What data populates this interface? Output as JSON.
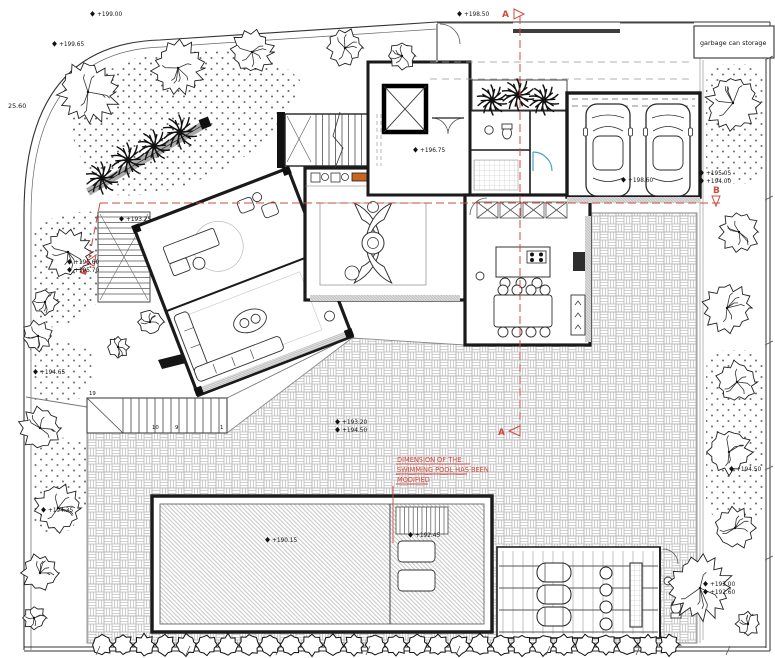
{
  "title": "villa-ground-floor-site-plan",
  "labels": {
    "garbage": "garbage can storage",
    "boundary_dim": "25.60",
    "note": [
      "DIMENSION OF THE",
      "SWIMMING POOL HAS BEEN",
      "MODIFIED"
    ],
    "section_a": "A",
    "section_b": "B",
    "steps": {
      "s19": "19",
      "s10": "10",
      "s9": "9",
      "s1": "1"
    }
  },
  "levels": {
    "p19900": "+199.00",
    "p19965": "+199.65",
    "p19850": "+198.50",
    "p19675": "+196.75",
    "p19860": "+198.60",
    "p19505": "+195.05",
    "p19400": "+194.00",
    "p19560": "+195.60",
    "p19570": "+195.70",
    "p19325": "+193.25",
    "p19465": "+194.65",
    "p19435": "+194.35",
    "p19320": "+193.20",
    "p19450": "+194.50",
    "p19450b": "+194.50",
    "p19015": "+190.15",
    "p19245": "+192.45",
    "p19300": "+193.00",
    "p19260": "+192.60"
  },
  "colors": {
    "section_red": "#d24a3e",
    "plant_green": "#4aa437",
    "fireplace_orange": "#c8651f",
    "door_blue": "#4a9fd4"
  }
}
